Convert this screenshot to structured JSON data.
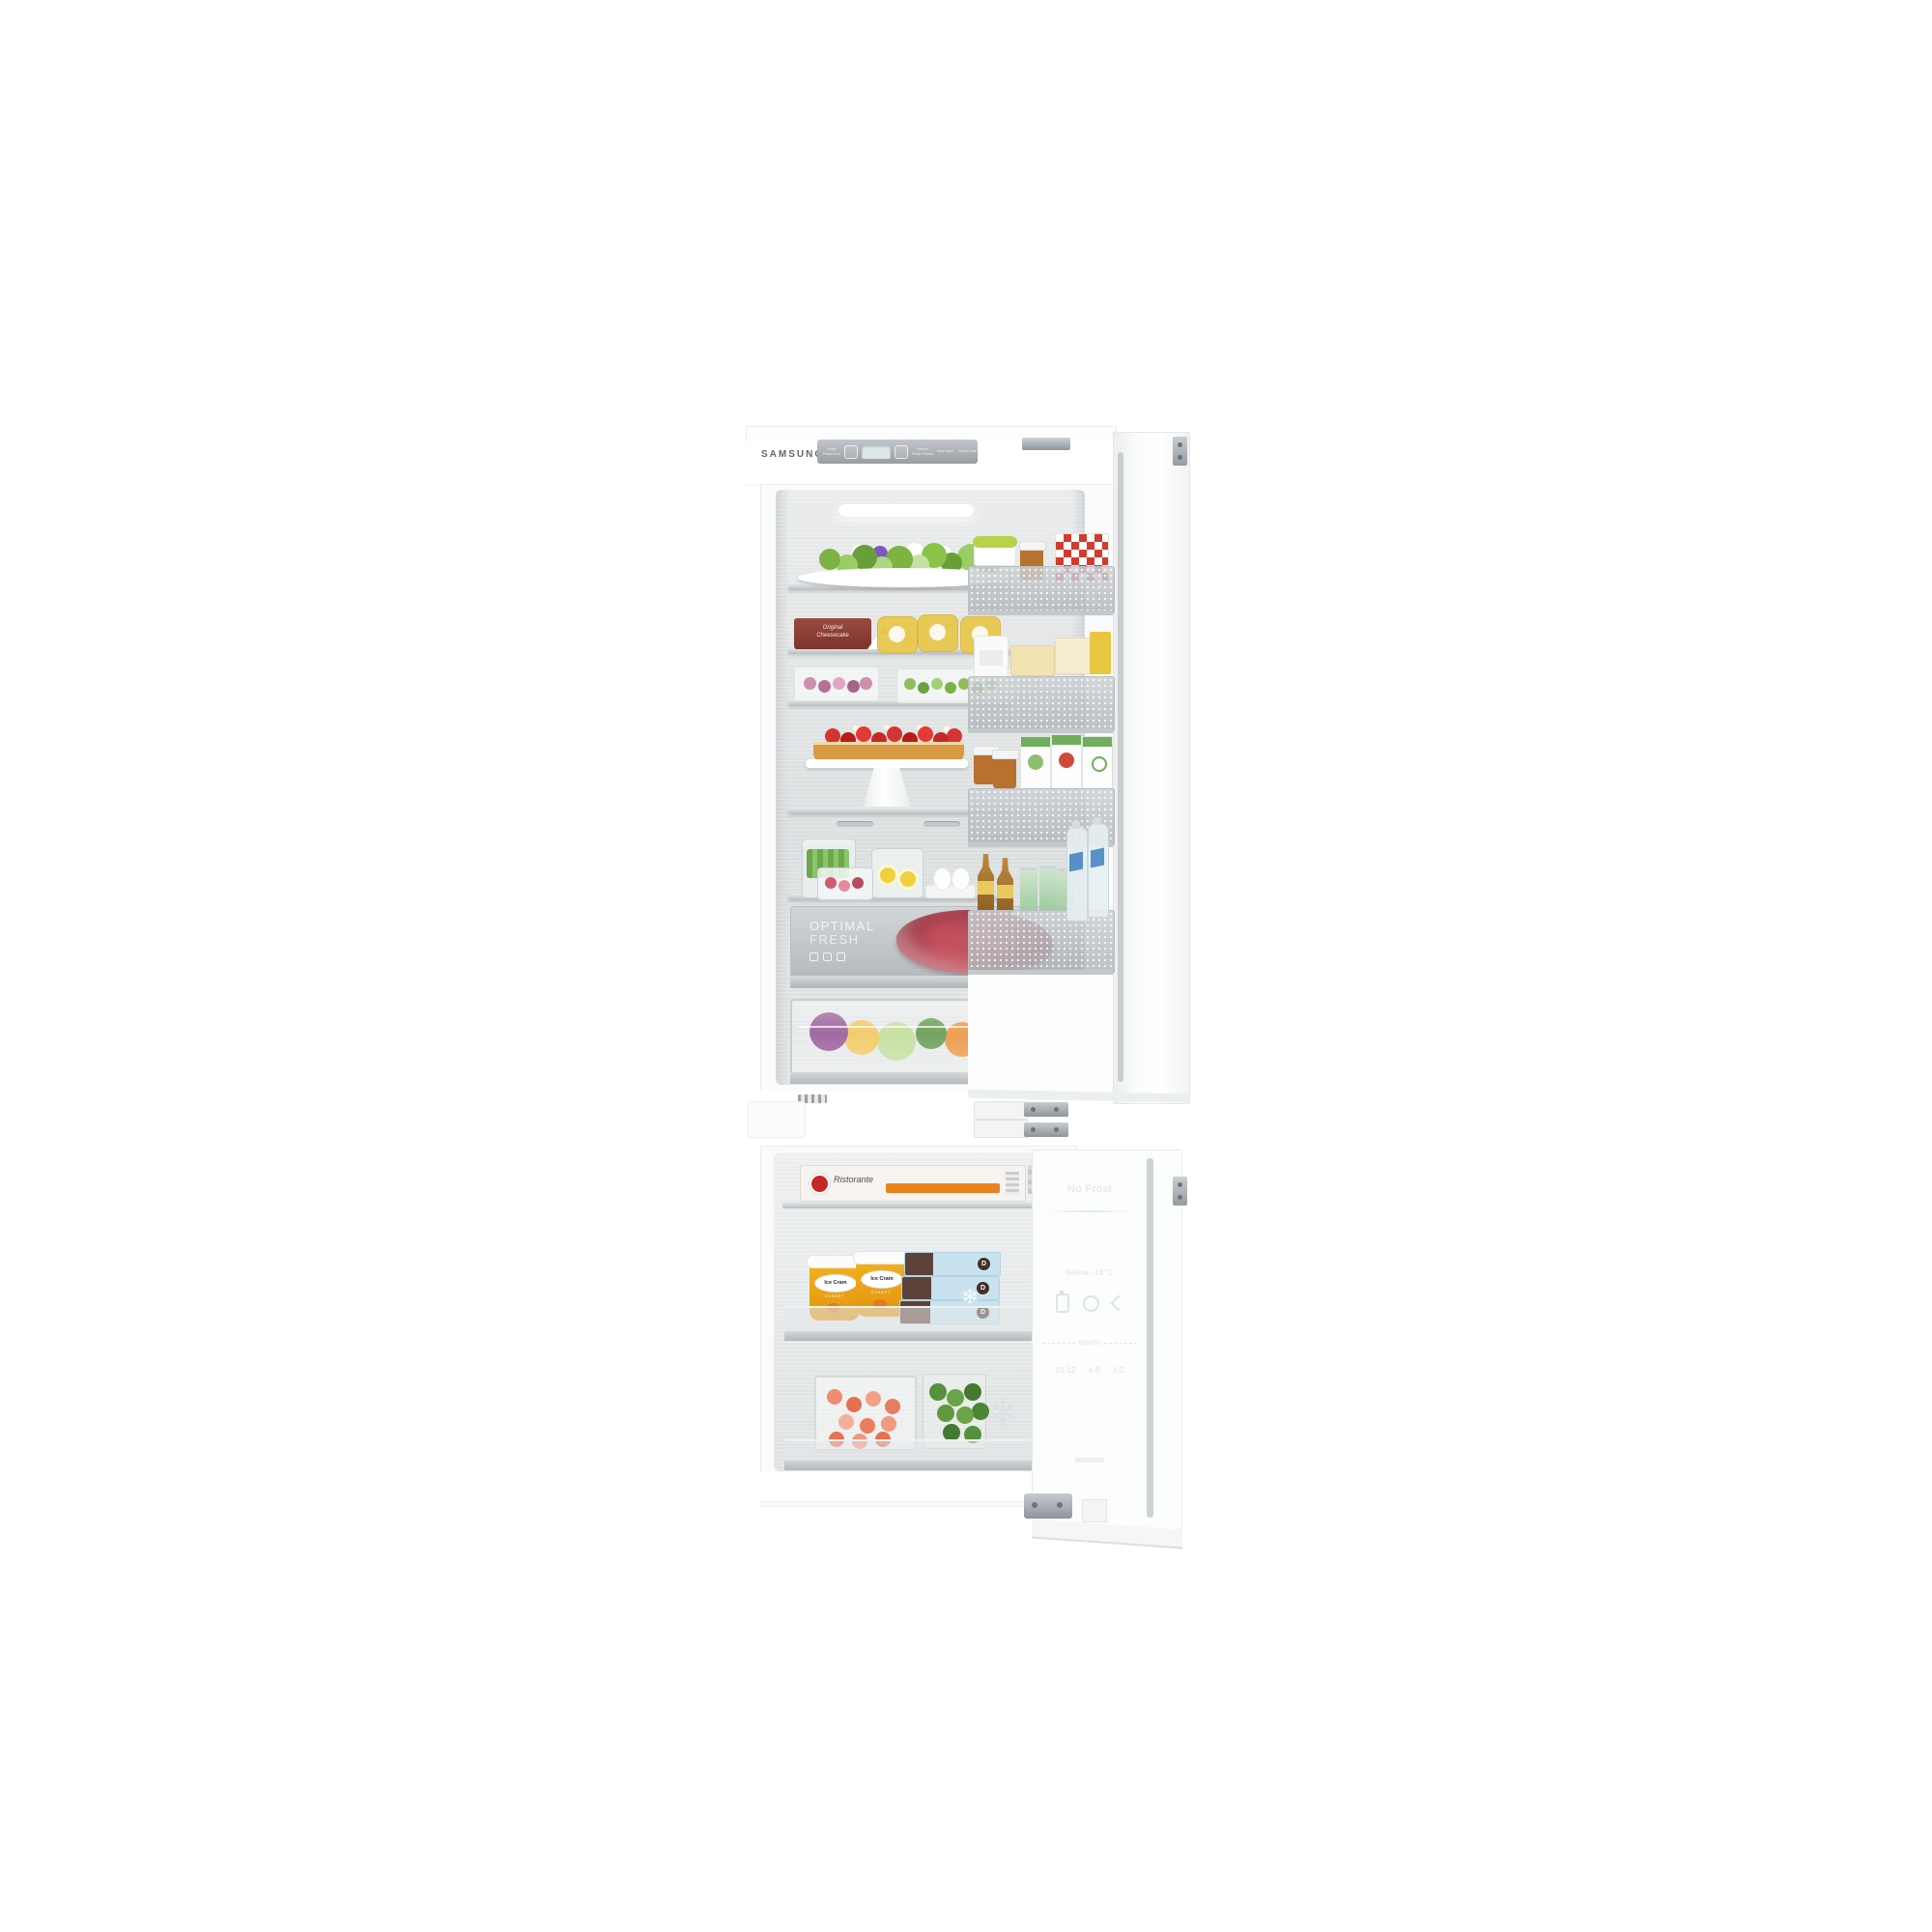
{
  "brand": "SAMSUNG",
  "control_panel": {
    "fridge": "Fridge",
    "power_cool": "Power Cool",
    "freezer": "Freezer",
    "power_freeze": "Power Freeze",
    "door_alarm": "Door Alarm",
    "control_lock": "Control Lock"
  },
  "fridge_compartment": {
    "cheesecake_line1": "Original",
    "cheesecake_line2": "Cheesecake",
    "optimal_fresh_line1": "OPTIMAL",
    "optimal_fresh_line2": "FRESH"
  },
  "freezer_compartment": {
    "pizza_brand": "Ristorante",
    "ice_cream_brand": "Ice Cram",
    "ice_cream_flavor": "SORBET",
    "bar_box_letter": "D"
  },
  "freezer_door": {
    "no_frost": "No Frost",
    "storage_heading": "Below -18°C",
    "months": "Months",
    "durations": [
      "10-12",
      "4-6",
      "1-2"
    ]
  },
  "icons": {
    "snowflake": "❄"
  },
  "palette": {
    "interior_steel": "#dfe2e3",
    "sorbet_orange": "#f0a01e",
    "freezer_box_blue": "#c8e3ef",
    "meat_red": "#a13a48",
    "pizza_band_orange": "#e8831f"
  }
}
